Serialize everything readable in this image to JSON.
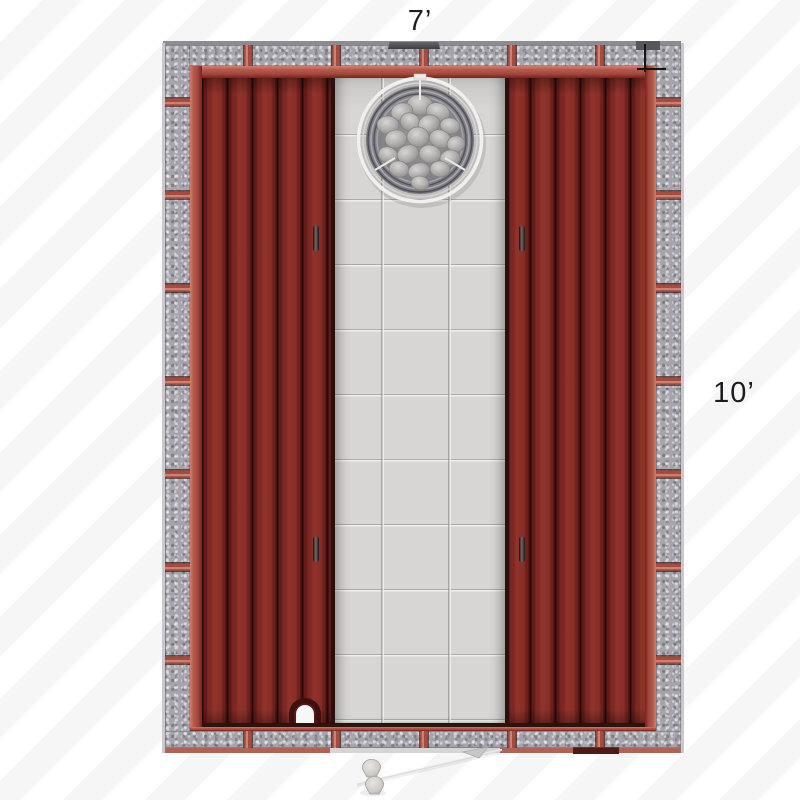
{
  "scene": {
    "title": "Sauna floor plan — top view",
    "dimensions": {
      "width_label": "7’",
      "depth_label": "10’"
    },
    "colors": {
      "wood_plank": "#7b2722",
      "wood_trim": "#a84b3f",
      "granite_stone": "#a5a4aa",
      "tile_floor": "#d7d6d4",
      "heater_ring": "#f1f0ee",
      "heater_stones": "#b4b3b1",
      "label_text": "#1c1c1e",
      "background_stripe": "#f6f6f7"
    },
    "components": {
      "heater": "round-heater-with-stones",
      "left_bench": "wood-plank-bench",
      "right_bench": "wood-plank-bench",
      "floor": "tile-floor",
      "door": "glass-door-open-with-handle",
      "arch_vent": "arched-vent-opening",
      "top_vent": "roof-vent-bar"
    }
  }
}
